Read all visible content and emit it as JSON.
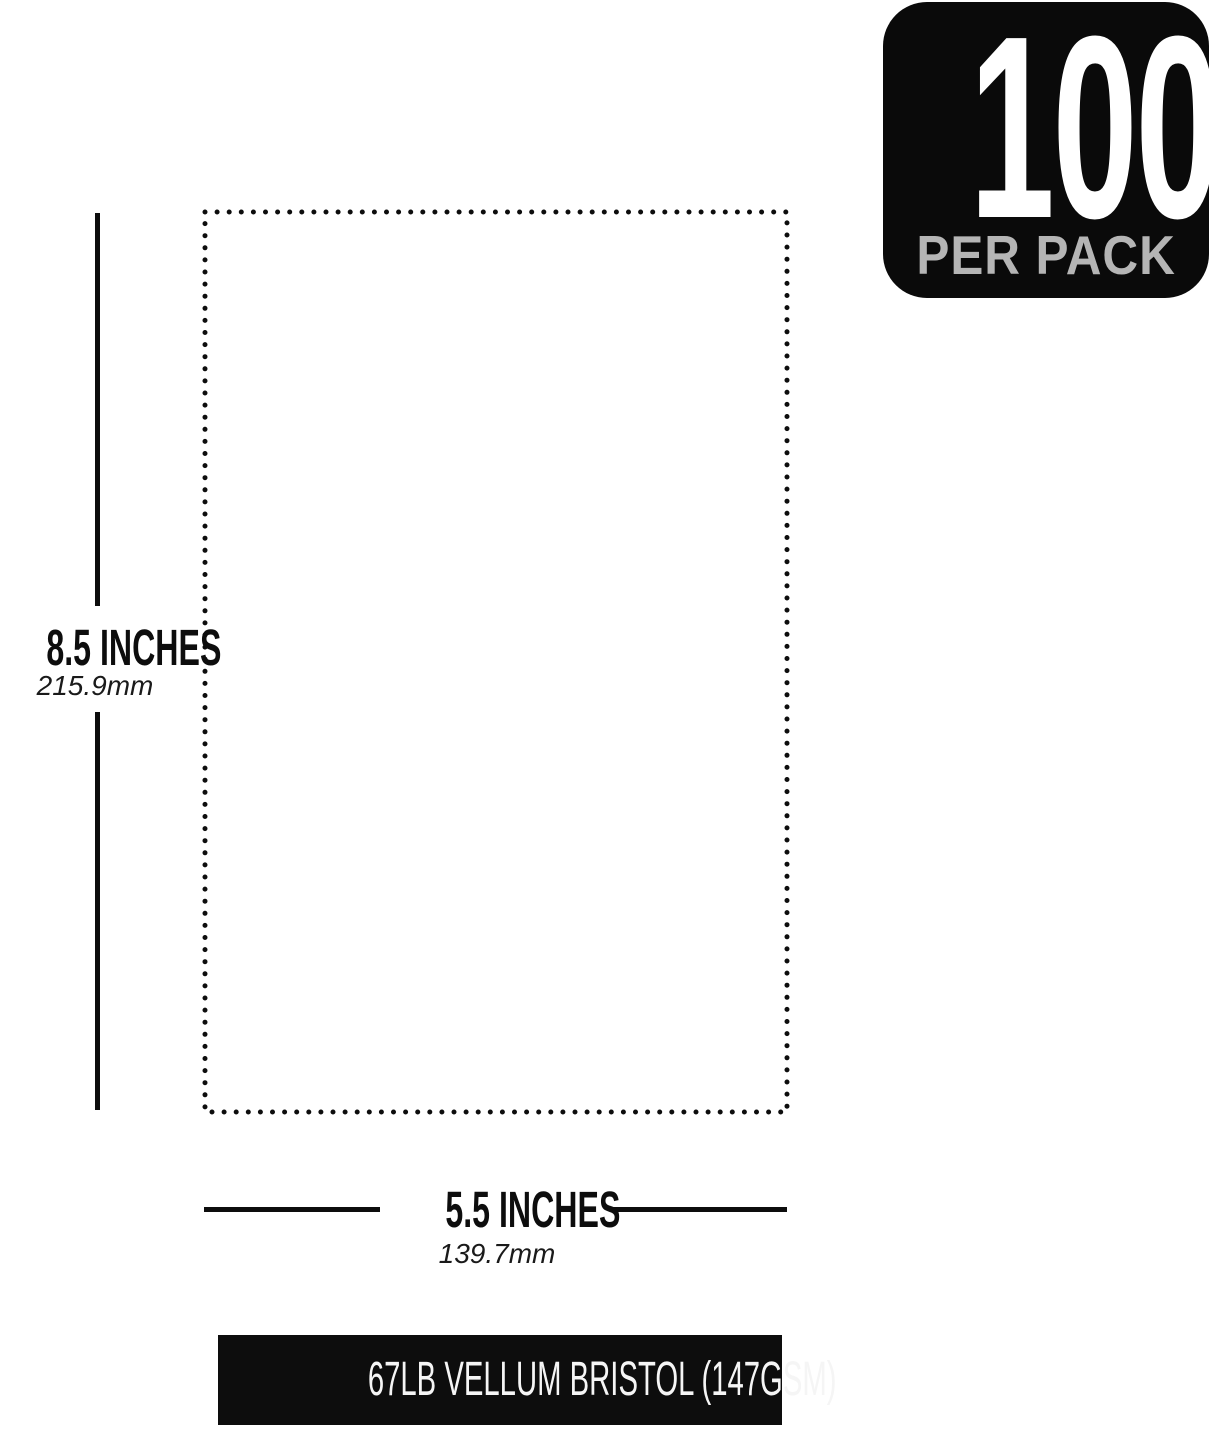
{
  "badge": {
    "count": "100",
    "label": "PER PACK"
  },
  "dimensions": {
    "height": {
      "label": "8.5 INCHES",
      "metric": "215.9mm"
    },
    "width": {
      "label": "5.5 INCHES",
      "metric": "139.7mm"
    }
  },
  "footer": {
    "text": "67LB VELLUM BRISTOL (147GSM)"
  },
  "colors": {
    "background": "#ffffff",
    "ink": "#0d0d0d",
    "badge_bg": "#0a0a0a",
    "badge_count": "#ffffff",
    "badge_label": "#b5b5b5",
    "footer_bg": "#0d0d0d",
    "footer_text": "#f5f5f5"
  }
}
